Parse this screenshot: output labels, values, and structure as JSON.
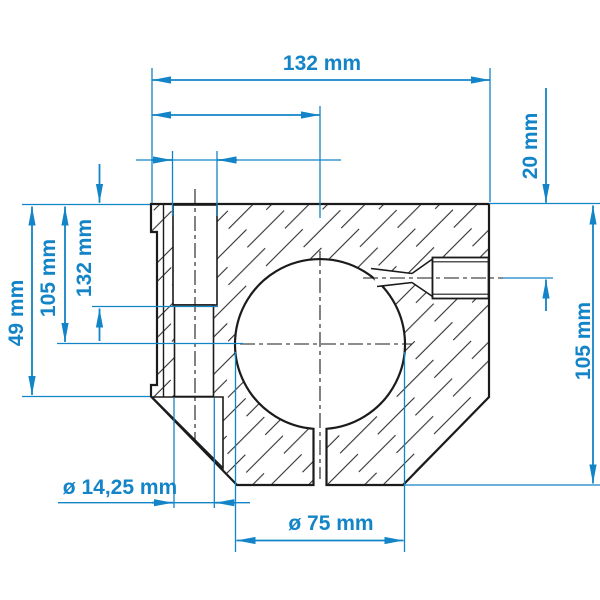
{
  "drawing": {
    "type": "technical-cross-section",
    "part": "shaft-support-block",
    "labels": {
      "top_width": "132 mm",
      "screw_offset": "20 mm",
      "right_height": "105 mm",
      "left_depth_counterbore": "132 mm",
      "left_depth_axis": "105 mm",
      "left_depth_flange": "49 mm",
      "hole_diameter": "ø 14,25 mm",
      "bore_diameter": "ø 75 mm"
    },
    "colors": {
      "dimension_blue": "#1284c7",
      "line_black": "#1b1b1b",
      "background": "#ffffff"
    }
  }
}
